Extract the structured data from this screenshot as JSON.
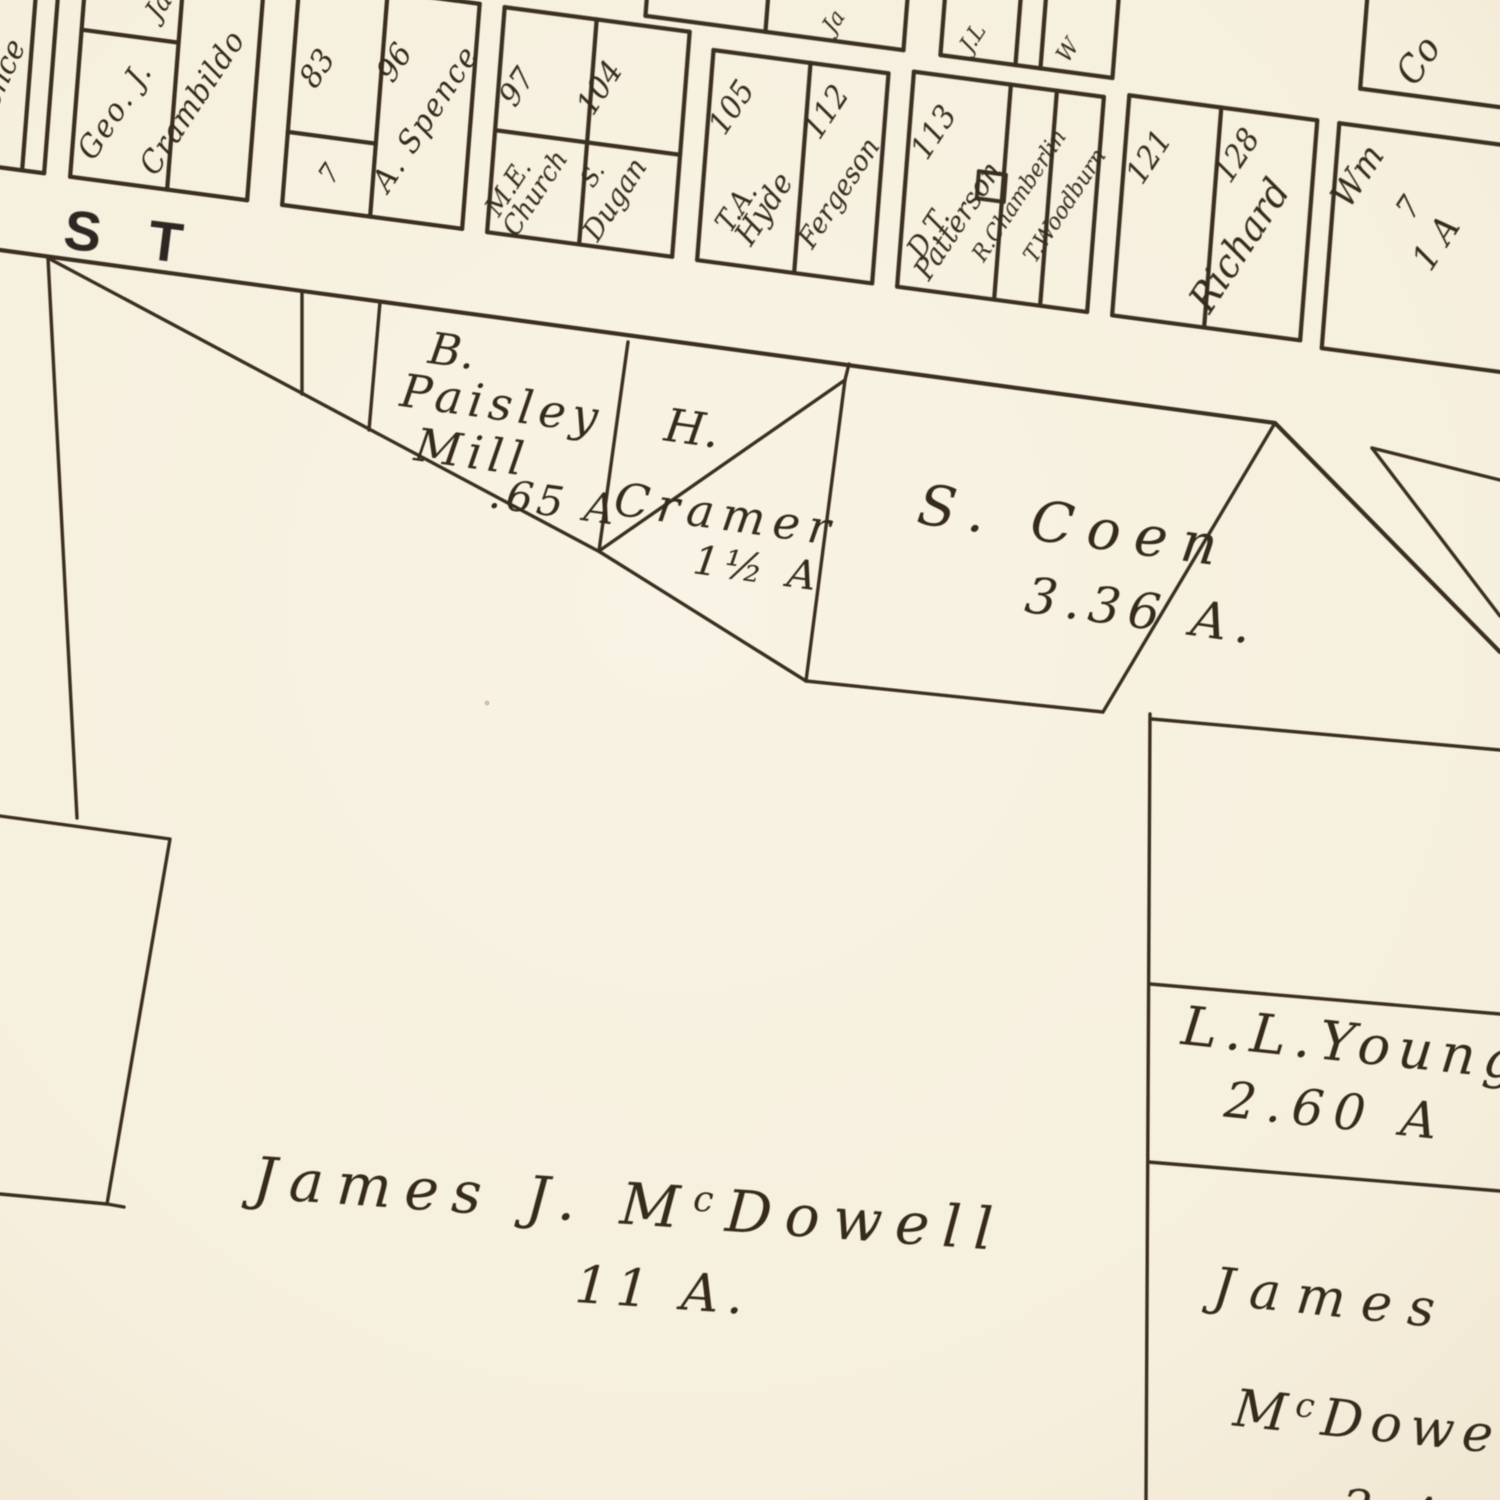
{
  "colors": {
    "ink": "#3a2f23",
    "paper": "#f7f1e1",
    "paper_edge": "#efe6d0"
  },
  "street": {
    "label": "S T"
  },
  "blocks": {
    "edge_fragment": "ence",
    "cramblido": {
      "owner_first": "Geo. J.",
      "owner_last": "Crambildo",
      "upper_fragment": "Ja"
    },
    "spence": {
      "lot_left": "83",
      "mark": "7",
      "lot_right": "96",
      "owner": "A. Spence"
    },
    "church": {
      "lot_left": "97",
      "lot_right": "104",
      "church_line1": "M.E.",
      "church_line2": "Church",
      "dugan_initial": "S.",
      "dugan_name": "Dugan"
    },
    "hyde": {
      "lot_left": "105",
      "hyde_line1": "T.A.",
      "hyde_line2": "Hyde",
      "lot_right": "112",
      "owner_right": "Fergeson"
    },
    "patterson": {
      "lot": "113",
      "owner_line1": "D.T.",
      "owner_line2": "Patterson",
      "strip1": "R.Chamberlin",
      "strip2": "T.Woodburn"
    },
    "richard": {
      "lot_left": "121",
      "lot_right": "128",
      "owner": "Richard"
    },
    "wm": {
      "owner": "Wm",
      "mark": "7",
      "area": "1 A"
    },
    "corner_lot": "Co",
    "north_fragments": [
      "Ja",
      "J.L",
      "W"
    ]
  },
  "parcels": {
    "paisley": {
      "line1": "B.",
      "line2": "Paisley",
      "line3": "Mill",
      "area": ".65 A"
    },
    "cramer": {
      "line1": "H.",
      "line2": "Cramer",
      "area": "1½ A"
    },
    "coen": {
      "name": "S. Coen",
      "area": "3.36 A."
    },
    "young": {
      "name": "L.L.Young",
      "area": "2.60 A"
    },
    "mcdowell_main": {
      "name_pre": "James J. M",
      "name_sup": "c",
      "name_post": "Dowell",
      "area": "11 A."
    },
    "mcdowell_right": {
      "line1": "James",
      "line2_pre": "M",
      "line2_sup": "c",
      "line2_post": "Dowell",
      "area": "2 A"
    }
  }
}
